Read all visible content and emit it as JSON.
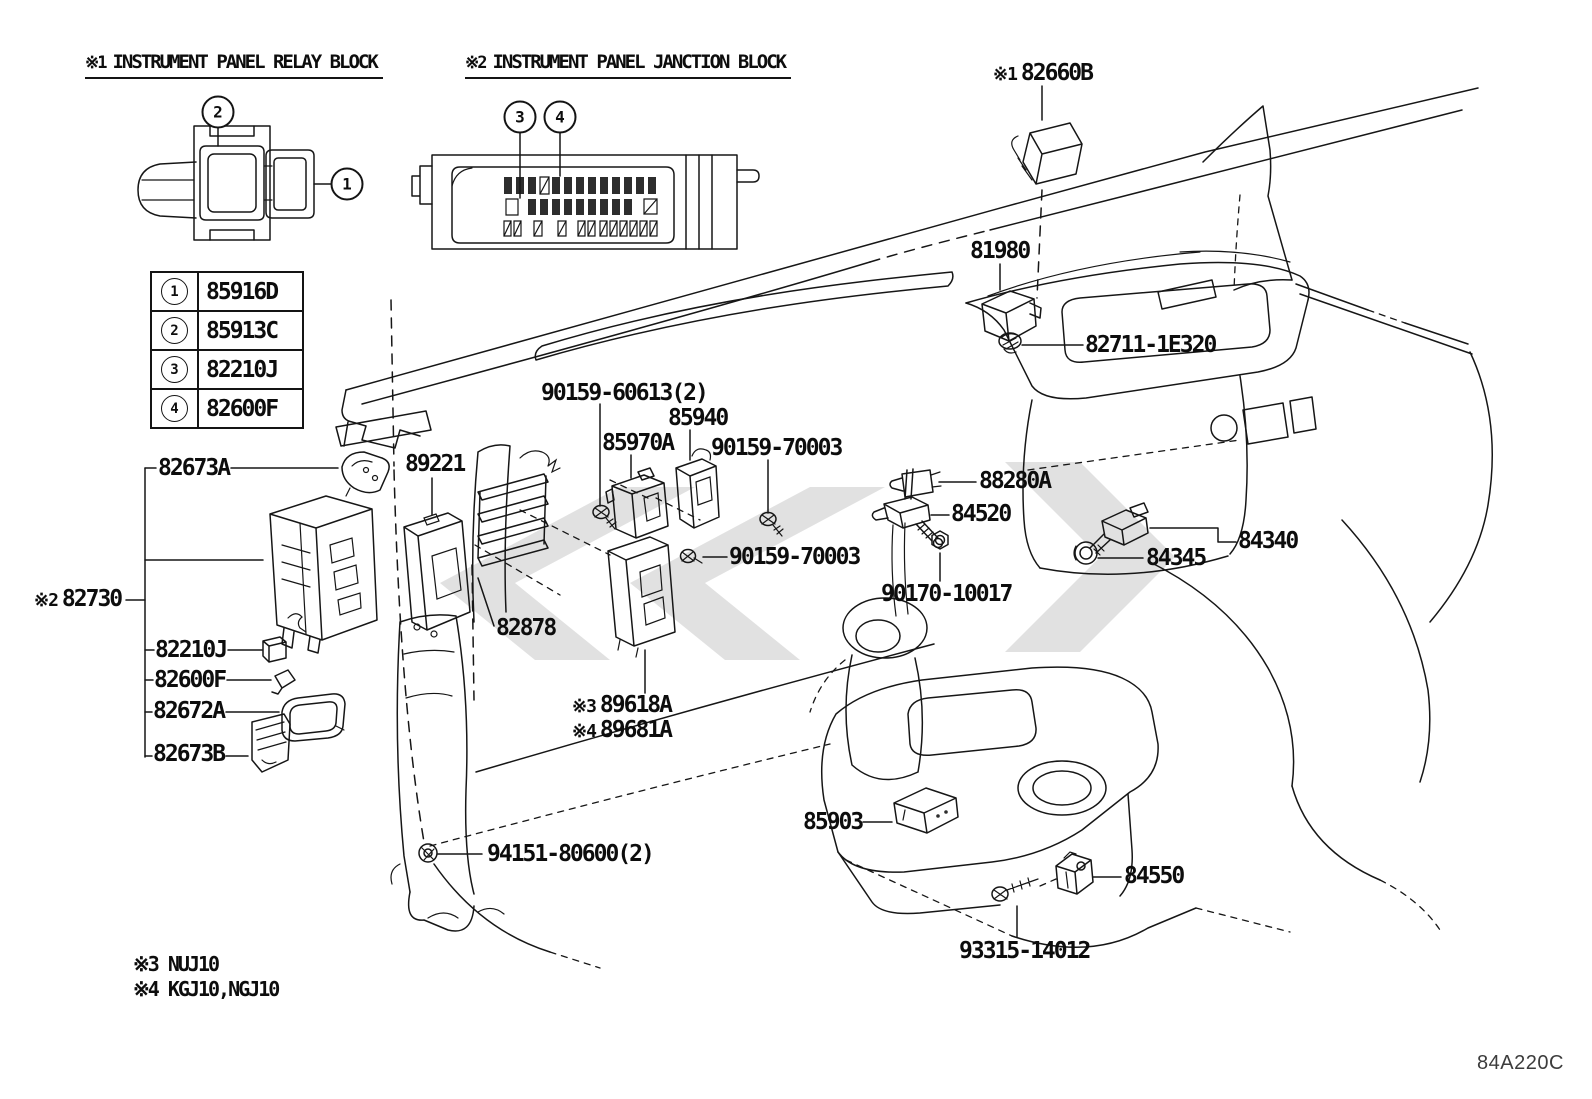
{
  "colors": {
    "line": "#161616",
    "watermark": "#c9c9c9",
    "background": "#ffffff"
  },
  "header": {
    "relay_block": {
      "prefix": "※1",
      "title": "INSTRUMENT PANEL RELAY BLOCK"
    },
    "junction_block": {
      "prefix": "※2",
      "title": "INSTRUMENT PANEL JANCTION BLOCK"
    }
  },
  "legend": {
    "rows": [
      {
        "num": "1",
        "part": "85916D"
      },
      {
        "num": "2",
        "part": "85913C"
      },
      {
        "num": "3",
        "part": "82210J"
      },
      {
        "num": "4",
        "part": "82600F"
      }
    ]
  },
  "callouts": [
    {
      "num": "2",
      "x": 218,
      "y": 112
    },
    {
      "num": "1",
      "x": 347,
      "y": 184
    },
    {
      "num": "3",
      "x": 520,
      "y": 117
    },
    {
      "num": "4",
      "x": 560,
      "y": 117
    }
  ],
  "part_labels": [
    {
      "prefix": "※1",
      "text": "82660B",
      "x": 993,
      "y": 62
    },
    {
      "text": "81980",
      "x": 970,
      "y": 240
    },
    {
      "text": "82711-1E320",
      "x": 1085,
      "y": 334
    },
    {
      "text": "90159-60613(2)",
      "x": 541,
      "y": 382
    },
    {
      "text": "85940",
      "x": 668,
      "y": 407
    },
    {
      "text": "85970A",
      "x": 602,
      "y": 432
    },
    {
      "text": "90159-70003",
      "x": 711,
      "y": 437
    },
    {
      "text": "88280A",
      "x": 979,
      "y": 470
    },
    {
      "text": "84520",
      "x": 951,
      "y": 503
    },
    {
      "text": "84340",
      "x": 1238,
      "y": 530
    },
    {
      "text": "84345",
      "x": 1146,
      "y": 547
    },
    {
      "text": "90159-70003",
      "x": 729,
      "y": 546
    },
    {
      "text": "90170-10017",
      "x": 881,
      "y": 583
    },
    {
      "text": "82673A",
      "x": 158,
      "y": 457
    },
    {
      "text": "89221",
      "x": 405,
      "y": 453
    },
    {
      "prefix": "※2",
      "text": "82730",
      "x": 34,
      "y": 588
    },
    {
      "text": "82878",
      "x": 496,
      "y": 617
    },
    {
      "text": "82210J",
      "x": 155,
      "y": 639
    },
    {
      "text": "82600F",
      "x": 154,
      "y": 669
    },
    {
      "text": "82672A",
      "x": 153,
      "y": 700
    },
    {
      "text": "82673B",
      "x": 153,
      "y": 743
    },
    {
      "prefix": "※3",
      "text": "89618A",
      "x": 572,
      "y": 694
    },
    {
      "prefix": "※4",
      "text": "89681A",
      "x": 572,
      "y": 719
    },
    {
      "text": "85903",
      "x": 803,
      "y": 811
    },
    {
      "text": "84550",
      "x": 1124,
      "y": 865
    },
    {
      "text": "94151-80600(2)",
      "x": 487,
      "y": 843
    },
    {
      "text": "93315-14012",
      "x": 959,
      "y": 940
    }
  ],
  "footnotes": [
    {
      "text": "※3 NUJ10",
      "x": 133,
      "y": 954
    },
    {
      "text": "※4 KGJ10,NGJ10",
      "x": 133,
      "y": 979
    }
  ],
  "diagram_code": {
    "text": "84A220C",
    "x": 1477,
    "y": 1053
  }
}
